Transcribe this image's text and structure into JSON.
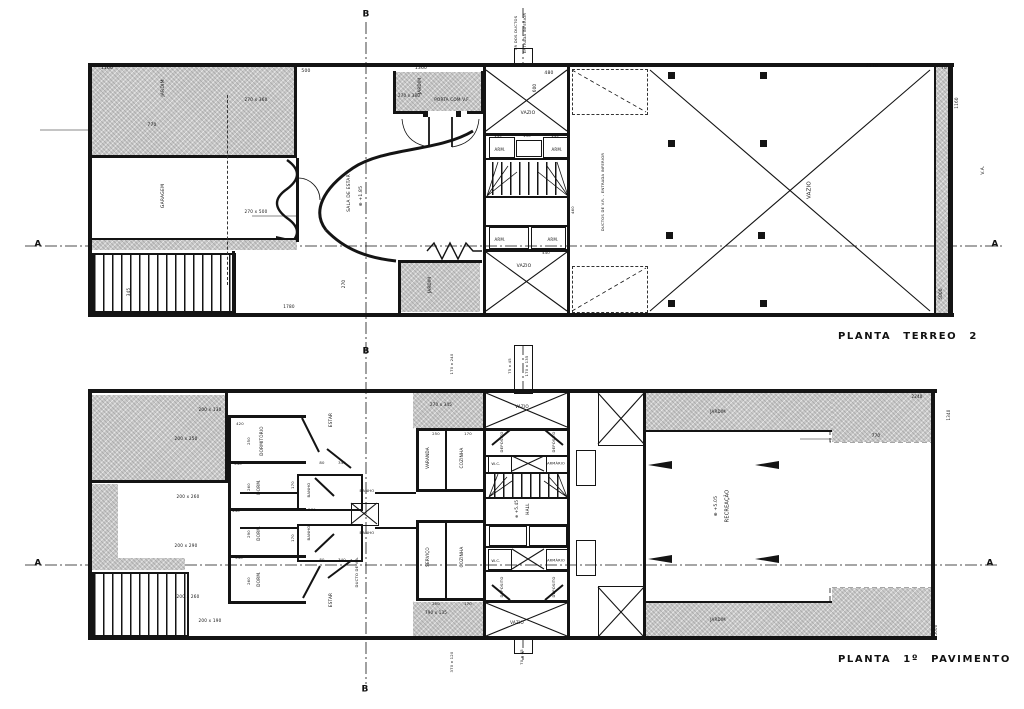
{
  "document": {
    "type": "architectural-floor-plan",
    "language": "pt-BR"
  },
  "colors": {
    "ink": "#141414",
    "paper": "#ffffff",
    "hatch_fill": "#c9c9c9"
  },
  "titles": {
    "plan1": "PLANTA  TERREO  2",
    "plan2": "PLANTA  1º  PAVIMENTO"
  },
  "labels": [
    {
      "n": "dim-label",
      "t": "1160",
      "x": 107,
      "y": 69,
      "s": 4.5
    },
    {
      "n": "dim-label",
      "t": "500",
      "x": 306,
      "y": 72,
      "s": 4.5
    },
    {
      "n": "dim-label",
      "t": "1360",
      "x": 421,
      "y": 69,
      "s": 4.5
    },
    {
      "n": "dim-label",
      "t": "480",
      "x": 549,
      "y": 74,
      "s": 4.5
    },
    {
      "n": "dim-label",
      "t": "600",
      "x": 535,
      "y": 88,
      "r": 1,
      "s": 4.2
    },
    {
      "n": "dim-label",
      "t": "2170",
      "x": 872,
      "y": 67,
      "s": 4.5
    },
    {
      "n": "dim-label",
      "t": "70",
      "x": 944,
      "y": 68,
      "s": 4.2
    },
    {
      "n": "dim-label",
      "t": "1160",
      "x": 957,
      "y": 103,
      "r": 1,
      "s": 4.2
    },
    {
      "n": "note-label",
      "t": "V.A.",
      "x": 984,
      "y": 170,
      "r": 1,
      "s": 4.5
    },
    {
      "n": "dim-label",
      "t": "5000",
      "x": 941,
      "y": 294,
      "r": 1,
      "s": 4.2
    },
    {
      "n": "room-label-jardim",
      "t": "JARDIM",
      "x": 164,
      "y": 88,
      "r": 1,
      "s": 4.5
    },
    {
      "n": "dim-label",
      "t": "770",
      "x": 152,
      "y": 126,
      "s": 4.5
    },
    {
      "n": "room-label-garagem",
      "t": "GARAGEM",
      "x": 164,
      "y": 196,
      "r": 1,
      "s": 4.5
    },
    {
      "n": "dim-label",
      "t": "270 x 360",
      "x": 256,
      "y": 100,
      "s": 4.2
    },
    {
      "n": "dim-label",
      "t": "270 x 500",
      "x": 256,
      "y": 212,
      "s": 4.2
    },
    {
      "n": "dim-label",
      "t": "345",
      "x": 129,
      "y": 292,
      "r": 1,
      "s": 4.2
    },
    {
      "n": "dim-label",
      "t": "1780",
      "x": 289,
      "y": 307,
      "s": 4.2
    },
    {
      "n": "dim-label",
      "t": "270",
      "x": 344,
      "y": 284,
      "r": 1,
      "s": 4.2
    },
    {
      "n": "room-label-jardim",
      "t": "JARDIM",
      "x": 430,
      "y": 285,
      "r": 1,
      "s": 4.2
    },
    {
      "n": "room-label-jardim",
      "t": "JARDIM",
      "x": 420,
      "y": 86,
      "r": 1,
      "s": 4.2
    },
    {
      "n": "note-label",
      "t": "PORTA COM V.F.",
      "x": 452,
      "y": 100,
      "s": 4.2
    },
    {
      "n": "dim-label",
      "t": "270 x 380",
      "x": 409,
      "y": 96,
      "s": 4
    },
    {
      "n": "room-label-vazio",
      "t": "VAZIO",
      "x": 528,
      "y": 114,
      "s": 4.5
    },
    {
      "n": "room-label-arm",
      "t": "ARM.",
      "x": 500,
      "y": 150,
      "s": 4
    },
    {
      "n": "room-label-arm",
      "t": "ARM.",
      "x": 557,
      "y": 150,
      "s": 4
    },
    {
      "n": "dim-label",
      "t": "145",
      "x": 498,
      "y": 136,
      "s": 3.8
    },
    {
      "n": "dim-label",
      "t": "130",
      "x": 527,
      "y": 136,
      "s": 3.8
    },
    {
      "n": "dim-label",
      "t": "145",
      "x": 555,
      "y": 136,
      "s": 3.8
    },
    {
      "n": "room-label-arm",
      "t": "ARM.",
      "x": 500,
      "y": 240,
      "s": 4
    },
    {
      "n": "room-label-arm",
      "t": "ARM.",
      "x": 553,
      "y": 240,
      "s": 4
    },
    {
      "n": "dim-label",
      "t": "440",
      "x": 546,
      "y": 253,
      "s": 3.8
    },
    {
      "n": "dim-label",
      "t": "460",
      "x": 573,
      "y": 210,
      "r": 1,
      "s": 3.8
    },
    {
      "n": "room-label-vazio",
      "t": "VAZIO",
      "x": 524,
      "y": 267,
      "s": 4.5
    },
    {
      "n": "room-label-vazio",
      "t": "VAZIO",
      "x": 810,
      "y": 190,
      "r": 1,
      "s": 5.5
    },
    {
      "n": "note-label",
      "t": "DUCTOS DE V.R. - ENTRADA INFERIOR",
      "x": 603,
      "y": 192,
      "r": 1,
      "s": 3.8
    },
    {
      "n": "note-label",
      "t": "VR DOS DUCTOS",
      "x": 516,
      "y": 33,
      "r": 1,
      "s": 3.8
    },
    {
      "n": "note-label",
      "t": "ENTRADA INFERIOR",
      "x": 525,
      "y": 33,
      "r": 1,
      "s": 3.8
    },
    {
      "n": "room-label-sala-de-estar",
      "t": "SALA DE ESTAR",
      "x": 350,
      "y": 193,
      "r": 1,
      "s": 4.5
    },
    {
      "n": "level-marker",
      "t": "⊕ +1.85",
      "x": 362,
      "y": 196,
      "r": 1,
      "s": 4.5
    },
    {
      "n": "section-marker-b",
      "t": "B",
      "x": 366,
      "y": 15,
      "s": 9,
      "b": 1
    },
    {
      "n": "section-marker-b",
      "t": "B",
      "x": 366,
      "y": 352,
      "s": 9,
      "b": 1
    },
    {
      "n": "section-marker-a",
      "t": "A",
      "x": 38,
      "y": 245,
      "s": 9,
      "b": 1
    },
    {
      "n": "section-marker-a",
      "t": "A",
      "x": 995,
      "y": 245,
      "s": 9,
      "b": 1
    },
    {
      "n": "dim-label",
      "t": "200 x 130",
      "x": 210,
      "y": 410,
      "s": 4.2
    },
    {
      "n": "dim-label",
      "t": "200 x 250",
      "x": 186,
      "y": 439,
      "s": 4.2
    },
    {
      "n": "dim-label",
      "t": "200 x 260",
      "x": 188,
      "y": 497,
      "s": 4.2
    },
    {
      "n": "dim-label",
      "t": "200 x 290",
      "x": 186,
      "y": 546,
      "s": 4.2
    },
    {
      "n": "dim-label",
      "t": "200 x 260",
      "x": 188,
      "y": 597,
      "s": 4.2
    },
    {
      "n": "dim-label",
      "t": "200 x 190",
      "x": 210,
      "y": 621,
      "s": 4.2
    },
    {
      "n": "dim-label",
      "t": "420",
      "x": 240,
      "y": 424,
      "s": 3.8
    },
    {
      "n": "dim-label",
      "t": "540",
      "x": 238,
      "y": 464,
      "s": 3.8
    },
    {
      "n": "dim-label",
      "t": "440",
      "x": 236,
      "y": 511,
      "s": 3.8
    },
    {
      "n": "dim-label",
      "t": "540",
      "x": 239,
      "y": 558,
      "s": 3.8
    },
    {
      "n": "dim-label",
      "t": "420",
      "x": 237,
      "y": 603,
      "s": 3.8
    },
    {
      "n": "dim-label",
      "t": "250",
      "x": 249,
      "y": 441,
      "r": 1,
      "s": 3.8
    },
    {
      "n": "dim-label",
      "t": "260",
      "x": 249,
      "y": 487,
      "r": 1,
      "s": 3.8
    },
    {
      "n": "dim-label",
      "t": "290",
      "x": 249,
      "y": 534,
      "r": 1,
      "s": 3.8
    },
    {
      "n": "dim-label",
      "t": "260",
      "x": 249,
      "y": 581,
      "r": 1,
      "s": 3.8
    },
    {
      "n": "room-label-dormitorio",
      "t": "DORMITÓRIO",
      "x": 262,
      "y": 441,
      "r": 1,
      "s": 4.2
    },
    {
      "n": "room-label-dorm",
      "t": "DORM.",
      "x": 259,
      "y": 487,
      "r": 1,
      "s": 4.2
    },
    {
      "n": "room-label-dorm",
      "t": "DORM.",
      "x": 259,
      "y": 533,
      "r": 1,
      "s": 4.2
    },
    {
      "n": "room-label-dorm",
      "t": "DORM.",
      "x": 259,
      "y": 579,
      "r": 1,
      "s": 4.2
    },
    {
      "n": "room-label-estar",
      "t": "ESTAR",
      "x": 331,
      "y": 420,
      "r": 1,
      "s": 4.2
    },
    {
      "n": "room-label-estar",
      "t": "ESTAR",
      "x": 331,
      "y": 600,
      "r": 1,
      "s": 4.2
    },
    {
      "n": "dim-label",
      "t": "80",
      "x": 322,
      "y": 463,
      "s": 3.8
    },
    {
      "n": "dim-label",
      "t": "340",
      "x": 342,
      "y": 463,
      "s": 3.8
    },
    {
      "n": "dim-label",
      "t": "80",
      "x": 322,
      "y": 560,
      "s": 3.8
    },
    {
      "n": "dim-label",
      "t": "340",
      "x": 342,
      "y": 560,
      "s": 3.8
    },
    {
      "n": "dim-label",
      "t": "170",
      "x": 293,
      "y": 485,
      "r": 1,
      "s": 3.8
    },
    {
      "n": "dim-label",
      "t": "170",
      "x": 293,
      "y": 538,
      "r": 1,
      "s": 3.8
    },
    {
      "n": "room-label-banho",
      "t": "BANHO",
      "x": 309,
      "y": 490,
      "r": 1,
      "s": 3.8
    },
    {
      "n": "room-label-banho",
      "t": "BANHO",
      "x": 309,
      "y": 533,
      "r": 1,
      "s": 3.8
    },
    {
      "n": "room-label-banho",
      "t": "BANHO",
      "x": 367,
      "y": 491,
      "s": 3.8
    },
    {
      "n": "room-label-banho",
      "t": "BANHO",
      "x": 367,
      "y": 533,
      "s": 3.8
    },
    {
      "n": "dim-label",
      "t": "270",
      "x": 312,
      "y": 510,
      "s": 3.8
    },
    {
      "n": "note-label",
      "t": "DUCTO DE V.A.",
      "x": 357,
      "y": 572,
      "r": 1,
      "s": 3.8
    },
    {
      "n": "room-label-varanda",
      "t": "VARANDA",
      "x": 428,
      "y": 458,
      "r": 1,
      "s": 4.2
    },
    {
      "n": "room-label-cozinha",
      "t": "COZINHA",
      "x": 462,
      "y": 458,
      "r": 1,
      "s": 4.2
    },
    {
      "n": "room-label-servico",
      "t": "SERVIÇO",
      "x": 428,
      "y": 557,
      "r": 1,
      "s": 4.2
    },
    {
      "n": "room-label-cozinha",
      "t": "COZINHA",
      "x": 462,
      "y": 557,
      "r": 1,
      "s": 4.2
    },
    {
      "n": "dim-label",
      "t": "250",
      "x": 436,
      "y": 434,
      "s": 3.8
    },
    {
      "n": "dim-label",
      "t": "170",
      "x": 468,
      "y": 434,
      "s": 3.8
    },
    {
      "n": "dim-label",
      "t": "250",
      "x": 436,
      "y": 604,
      "s": 3.8
    },
    {
      "n": "dim-label",
      "t": "170",
      "x": 468,
      "y": 604,
      "s": 3.8
    },
    {
      "n": "dim-label",
      "t": "270 x 345",
      "x": 441,
      "y": 405,
      "s": 4
    },
    {
      "n": "dim-label",
      "t": "790 x 135",
      "x": 436,
      "y": 613,
      "s": 4
    },
    {
      "n": "room-label-vazio",
      "t": "VAZIO",
      "x": 522,
      "y": 407,
      "s": 4.2
    },
    {
      "n": "room-label-vazio",
      "t": "VAZIO",
      "x": 517,
      "y": 623,
      "s": 4.2
    },
    {
      "n": "room-label-deposito",
      "t": "DEPÓSITO",
      "x": 502,
      "y": 442,
      "r": 1,
      "s": 3.8
    },
    {
      "n": "room-label-deposito",
      "t": "DEPÓSITO",
      "x": 554,
      "y": 442,
      "r": 1,
      "s": 3.8
    },
    {
      "n": "room-label-deposito",
      "t": "DEPÓSITO",
      "x": 502,
      "y": 587,
      "r": 1,
      "s": 3.8
    },
    {
      "n": "room-label-deposito",
      "t": "DEPÓSITO",
      "x": 554,
      "y": 587,
      "r": 1,
      "s": 3.8
    },
    {
      "n": "room-label-wc",
      "t": "W.C.",
      "x": 496,
      "y": 464,
      "s": 3.8
    },
    {
      "n": "room-label-armario",
      "t": "ARMÁRIO",
      "x": 556,
      "y": 464,
      "s": 3.5
    },
    {
      "n": "room-label-wc",
      "t": "W.C.",
      "x": 496,
      "y": 561,
      "s": 3.8
    },
    {
      "n": "room-label-armario",
      "t": "ARMÁRIO",
      "x": 556,
      "y": 561,
      "s": 3.5
    },
    {
      "n": "room-label-hall",
      "t": "HALL",
      "x": 528,
      "y": 509,
      "r": 1,
      "s": 4.2
    },
    {
      "n": "level-marker",
      "t": "⊕ +5.45",
      "x": 517,
      "y": 509,
      "r": 1,
      "s": 4
    },
    {
      "n": "room-label-recreacao",
      "t": "RECREAÇÃO",
      "x": 728,
      "y": 506,
      "r": 1,
      "s": 5
    },
    {
      "n": "level-marker",
      "t": "⊕ +5.05",
      "x": 717,
      "y": 506,
      "r": 1,
      "s": 4.5
    },
    {
      "n": "room-label-jardim",
      "t": "JARDIM",
      "x": 718,
      "y": 412,
      "s": 4
    },
    {
      "n": "room-label-jardim",
      "t": "JARDIM",
      "x": 718,
      "y": 620,
      "s": 4
    },
    {
      "n": "dim-label",
      "t": "770",
      "x": 876,
      "y": 436,
      "s": 4.2
    },
    {
      "n": "dim-label",
      "t": "2240",
      "x": 917,
      "y": 397,
      "s": 4
    },
    {
      "n": "dim-label",
      "t": "1340",
      "x": 949,
      "y": 415,
      "r": 1,
      "s": 4
    },
    {
      "n": "dim-label",
      "t": "5000",
      "x": 936,
      "y": 630,
      "r": 1,
      "s": 4
    },
    {
      "n": "dim-label",
      "t": "170 x 240",
      "x": 452,
      "y": 364,
      "r": 1,
      "s": 3.8
    },
    {
      "n": "dim-label",
      "t": "75 x 45",
      "x": 510,
      "y": 366,
      "r": 1,
      "s": 3.8
    },
    {
      "n": "dim-label",
      "t": "170 x 135",
      "x": 527,
      "y": 366,
      "r": 1,
      "s": 3.8
    },
    {
      "n": "dim-label",
      "t": "370 x 120",
      "x": 452,
      "y": 662,
      "r": 1,
      "s": 3.8
    },
    {
      "n": "dim-label",
      "t": "70 x 45",
      "x": 522,
      "y": 657,
      "r": 1,
      "s": 3.8
    },
    {
      "n": "section-marker-b",
      "t": "B",
      "x": 365,
      "y": 690,
      "s": 9,
      "b": 1
    },
    {
      "n": "section-marker-a",
      "t": "A",
      "x": 38,
      "y": 564,
      "s": 9,
      "b": 1
    },
    {
      "n": "section-marker-a",
      "t": "A",
      "x": 990,
      "y": 564,
      "s": 9,
      "b": 1
    }
  ]
}
